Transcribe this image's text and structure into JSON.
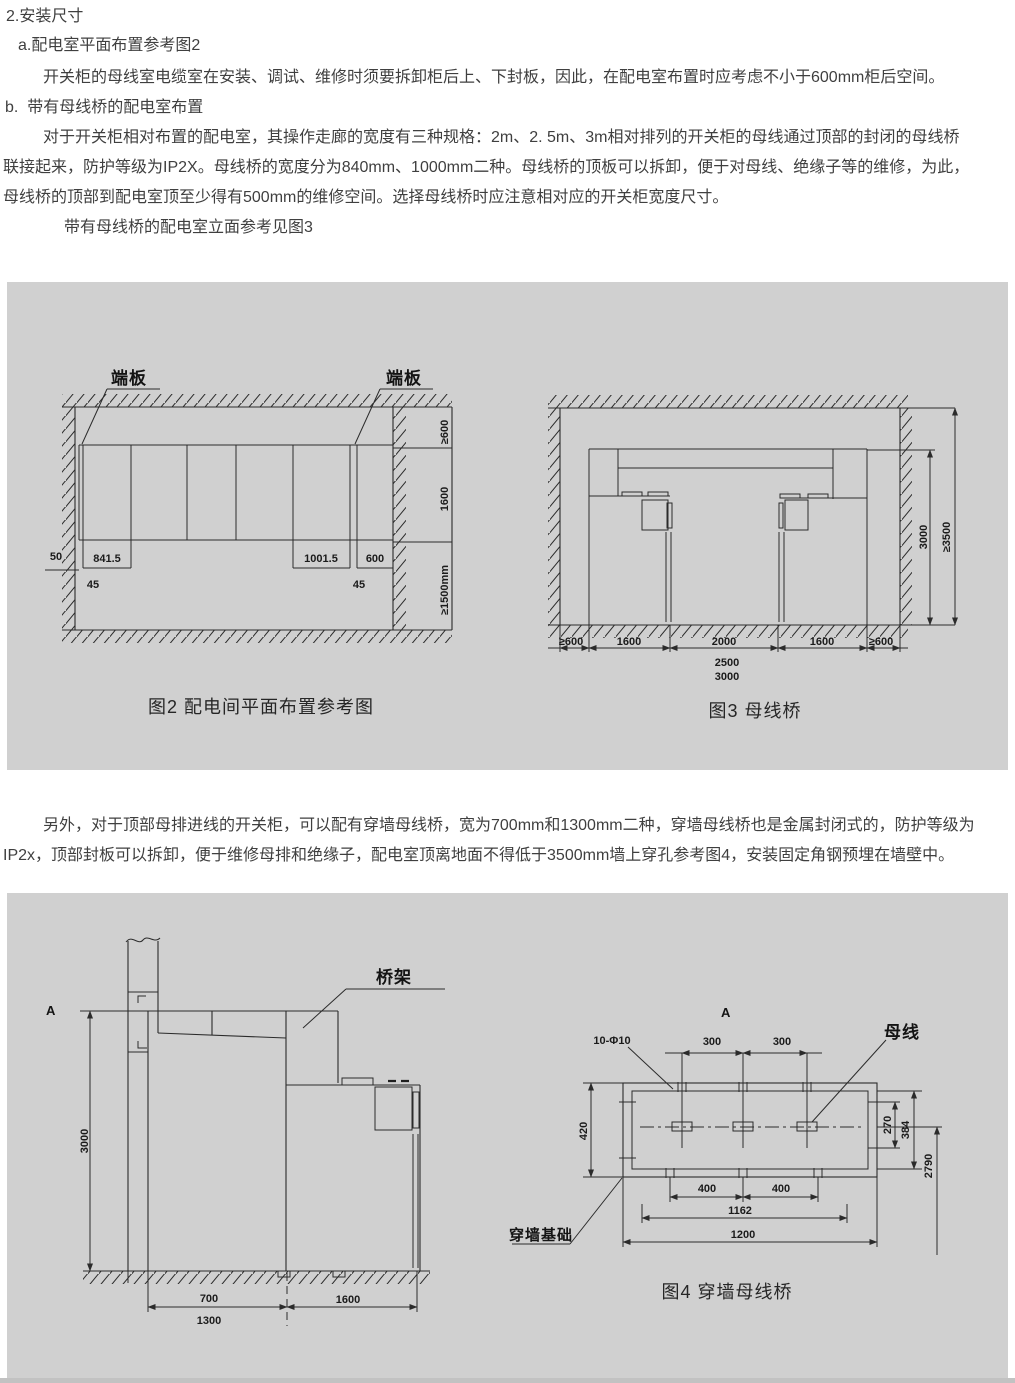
{
  "page": {
    "bg": "#ffffff",
    "panel_bg": "#d0d0d0",
    "ink": "#2b2b2b",
    "text_color": "#3f3f3f"
  },
  "intro": {
    "heading": "2.安装尺寸",
    "item_a": "a.配电室平面布置参考图2",
    "para_a": "开关柜的母线室电缆室在安装、调试、维修时须要拆卸柜后上、下封板，因此，在配电室布置时应考虑不小于600mm柜后空间。",
    "item_b": "b.  带有母线桥的配电室布置",
    "para_b_line1": "对于开关柜相对布置的配电室，其操作走廊的宽度有三种规格：2m、2. 5m、3m相对排列的开关柜的母线通过顶部的封闭的母线桥",
    "para_b_line2": "联接起来，防护等级为IP2X。母线桥的宽度分为840mm、1000mm二种。母线桥的顶板可以拆卸，便于对母线、绝缘子等的维修，为此，",
    "para_b_line3": "母线桥的顶部到配电室顶至少得有500mm的维修空间。选择母线桥时应注意相对应的开关柜宽度尺寸。",
    "para_b_line4": "带有母线桥的配电室立面参考见图3"
  },
  "middle": {
    "line1": "另外，对于顶部母排进线的开关柜，可以配有穿墙母线桥，宽为700mm和1300mm二种，穿墙母线桥也是金属封闭式的，防护等级为",
    "line2": "IP2x，顶部封板可以拆卸，便于维修母排和绝缘子，配电室顶离地面不得低于3500mm墙上穿孔参考图4，安装固定角钢预埋在墙壁中。"
  },
  "fig2": {
    "caption": "图2 配电间平面布置参考图",
    "endplate_left": "端板",
    "endplate_right": "端板",
    "dim_cabinet_w1": "841.5",
    "dim_cabinet_w2": "1001.5",
    "dim_gap_600": "600",
    "dim_50": "50",
    "dim_45_left": "45",
    "dim_45_right": "45",
    "dim_back_clearance": "≥600",
    "dim_depth": "1600",
    "dim_corridor": "≥1500mm"
  },
  "fig3": {
    "caption": "图3 母线桥",
    "dim_left_clearance": "≥600",
    "dim_left_cabinet": "1600",
    "dim_corridor": "2000",
    "dim_right_cabinet": "1600",
    "dim_right_clearance": "≥600",
    "dim_corridor_alt1": "2500",
    "dim_corridor_alt2": "3000",
    "dim_bridge_height": "3000",
    "dim_room_height": "≥3500"
  },
  "fig_wall": {
    "section_mark": "A",
    "bridge_label": "桥架",
    "dim_height": "3000",
    "dim_duct_w": "700",
    "dim_cabinet": "1600",
    "dim_duct_w_alt": "1300"
  },
  "fig4": {
    "caption": "图4 穿墙母线桥",
    "section_mark": "A",
    "holes_label": "10-Φ10",
    "busbar_label": "母线",
    "foundation_label": "穿墙基础",
    "dim_300_l": "300",
    "dim_300_r": "300",
    "dim_420": "420",
    "dim_270": "270",
    "dim_384": "384",
    "dim_2790": "2790",
    "dim_400_l": "400",
    "dim_400_r": "400",
    "dim_1162": "1162",
    "dim_1200": "1200"
  }
}
